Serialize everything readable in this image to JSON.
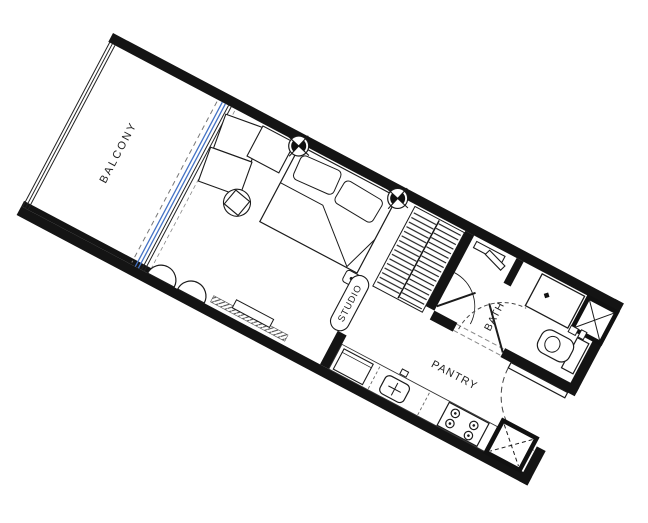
{
  "plan": {
    "type": "apartment-floor-plan",
    "unit_type": "studio",
    "rotation_deg": 28,
    "rooms": {
      "balcony": "BALCONY",
      "studio": "STUDIO",
      "bath": "BATH",
      "pantry": "PANTRY"
    },
    "fixtures": [
      "glass-sliding-door",
      "balcony-railing",
      "l-shaped-sofa",
      "coffee-table",
      "double-bed",
      "pillows",
      "bedside-stool",
      "ceiling-light-symbol",
      "ceiling-light-symbol",
      "tv-console",
      "lounge-chair",
      "lounge-chair",
      "wardrobe-hanging-rail",
      "shower",
      "shower-door",
      "bath-door",
      "vanity-basin",
      "toilet",
      "duct-shaft-top",
      "duct-shaft-bottom",
      "refrigerator",
      "kitchen-sink",
      "cooktop-4-burner",
      "entry-door"
    ],
    "colors": {
      "walls": "#141414",
      "lines": "#1b1b1b",
      "glass_door": "#4472c4",
      "background": "#ffffff"
    }
  }
}
